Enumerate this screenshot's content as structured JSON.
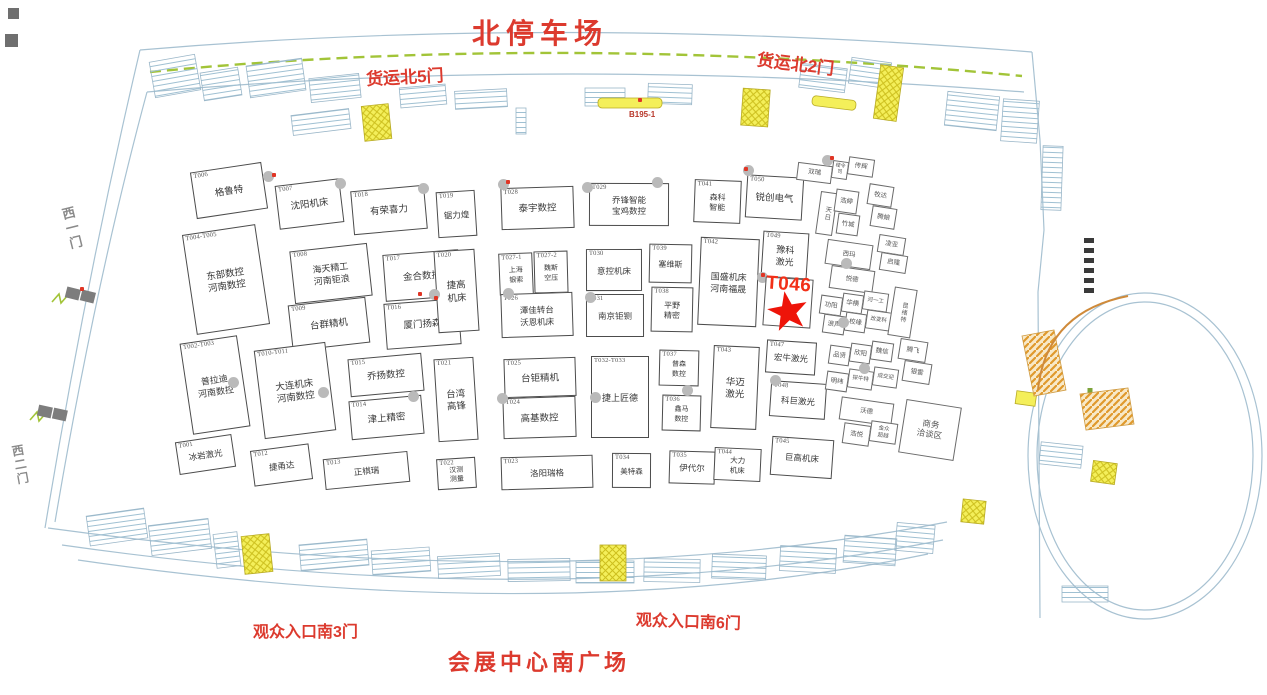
{
  "labels": {
    "north_parking": "北停车场",
    "freight_gate_5": "货运北5门",
    "freight_gate_2": "货运北2门",
    "west_gate_1": "西一门",
    "west_gate_2": "西二门",
    "south_entrance_3": "观众入口南3门",
    "south_entrance_6": "观众入口南6门",
    "south_plaza": "会展中心南广场",
    "zone_code": "B195-1",
    "highlight_code": "T046"
  },
  "colors": {
    "label_red": "#DC3A2E",
    "star_red": "#EE1409",
    "booth_border": "#4C4C4C",
    "green_edge": "#A2C438",
    "stair_yellow": "#F4EF5A",
    "escalator_orange": "#E0992C",
    "wall_blue": "#A8C2D2",
    "pillar_gray": "#BABABA"
  },
  "booths": [
    {
      "code": "T006",
      "name": "格鲁特",
      "x": 193,
      "y": 167,
      "w": 72,
      "h": 47
    },
    {
      "code": "T007",
      "name": "沈阳机床",
      "x": 277,
      "y": 182,
      "w": 65,
      "h": 44
    },
    {
      "code": "T018",
      "name": "有荣喜力",
      "x": 352,
      "y": 188,
      "w": 74,
      "h": 44
    },
    {
      "code": "T019",
      "name": "锯力煌",
      "x": 437,
      "y": 191,
      "w": 39,
      "h": 46,
      "fs": 8.5
    },
    {
      "code": "T028",
      "name": "泰宇数控",
      "x": 501,
      "y": 187,
      "w": 73,
      "h": 42
    },
    {
      "code": "T029",
      "name": "乔锋智能\n宝鸡数控",
      "x": 589,
      "y": 183,
      "w": 80,
      "h": 43,
      "fs": 8.5
    },
    {
      "code": "T041",
      "name": "森科\n智能",
      "x": 694,
      "y": 180,
      "w": 47,
      "h": 43,
      "fs": 8
    },
    {
      "code": "T050",
      "name": "锐创电气",
      "x": 746,
      "y": 176,
      "w": 57,
      "h": 43
    },
    {
      "code": "T004-T005",
      "name": "东部数控\n河南数控",
      "x": 189,
      "y": 229,
      "w": 74,
      "h": 101
    },
    {
      "code": "T008",
      "name": "海天精工\n河南钜浪",
      "x": 292,
      "y": 247,
      "w": 78,
      "h": 53,
      "fs": 9
    },
    {
      "code": "T009",
      "name": "台群精机",
      "x": 290,
      "y": 301,
      "w": 78,
      "h": 46
    },
    {
      "code": "T017",
      "name": "金合数控",
      "x": 384,
      "y": 252,
      "w": 76,
      "h": 47
    },
    {
      "code": "T016",
      "name": "厦门扬森",
      "x": 385,
      "y": 301,
      "w": 75,
      "h": 46
    },
    {
      "code": "T020",
      "name": "捷高\n机床",
      "x": 436,
      "y": 250,
      "w": 41,
      "h": 82
    },
    {
      "code": "T027-1",
      "name": "上海\n银索",
      "x": 499,
      "y": 253,
      "w": 34,
      "h": 42,
      "fs": 7
    },
    {
      "code": "T027-2",
      "name": "魏斯\n空压",
      "x": 534,
      "y": 251,
      "w": 34,
      "h": 42,
      "fs": 7
    },
    {
      "code": "T026",
      "name": "潭佳转台\n沃恩机床",
      "x": 501,
      "y": 293,
      "w": 72,
      "h": 44,
      "fs": 8.5
    },
    {
      "code": "T030",
      "name": "意控机床",
      "x": 586,
      "y": 249,
      "w": 56,
      "h": 42,
      "fs": 8.5
    },
    {
      "code": "T031",
      "name": "南京钜铡",
      "x": 586,
      "y": 294,
      "w": 58,
      "h": 43,
      "fs": 8.5
    },
    {
      "code": "T039",
      "name": "塞维斯",
      "x": 649,
      "y": 244,
      "w": 43,
      "h": 39,
      "fs": 8
    },
    {
      "code": "T038",
      "name": "平野\n精密",
      "x": 651,
      "y": 287,
      "w": 42,
      "h": 45,
      "fs": 8
    },
    {
      "code": "T042",
      "name": "国盛机床\n河南福晟",
      "x": 699,
      "y": 238,
      "w": 59,
      "h": 88,
      "fs": 9
    },
    {
      "code": "T049",
      "name": "豫科\n激光",
      "x": 762,
      "y": 232,
      "w": 46,
      "h": 46,
      "fs": 9
    },
    {
      "code": "T002-T003",
      "name": "普拉迪\n河南数控",
      "x": 186,
      "y": 339,
      "w": 58,
      "h": 92,
      "fs": 9
    },
    {
      "code": "T010-T011",
      "name": "大连机床\n河南数控",
      "x": 259,
      "y": 346,
      "w": 72,
      "h": 89
    },
    {
      "code": "T015",
      "name": "乔扬数控",
      "x": 349,
      "y": 356,
      "w": 74,
      "h": 38
    },
    {
      "code": "T014",
      "name": "津上精密",
      "x": 350,
      "y": 398,
      "w": 73,
      "h": 39
    },
    {
      "code": "T021",
      "name": "台湾\n高锋",
      "x": 436,
      "y": 358,
      "w": 40,
      "h": 83
    },
    {
      "code": "T025",
      "name": "台钜精机",
      "x": 504,
      "y": 358,
      "w": 72,
      "h": 39
    },
    {
      "code": "T024",
      "name": "高基数控",
      "x": 503,
      "y": 397,
      "w": 73,
      "h": 41
    },
    {
      "code": "T032-T033",
      "name": "捷上匠德",
      "x": 591,
      "y": 356,
      "w": 58,
      "h": 82,
      "fs": 9
    },
    {
      "code": "T037",
      "name": "普森\n数控",
      "x": 659,
      "y": 350,
      "w": 40,
      "h": 36,
      "fs": 7
    },
    {
      "code": "T036",
      "name": "鑫马\n数控",
      "x": 662,
      "y": 395,
      "w": 39,
      "h": 36,
      "fs": 7
    },
    {
      "code": "T043",
      "name": "华迈\n激光",
      "x": 712,
      "y": 346,
      "w": 46,
      "h": 83
    },
    {
      "code": "T047",
      "name": "宏牛激光",
      "x": 766,
      "y": 341,
      "w": 50,
      "h": 33,
      "fs": 8.5
    },
    {
      "code": "T048",
      "name": "科巨激光",
      "x": 770,
      "y": 382,
      "w": 56,
      "h": 36,
      "fs": 8.5
    },
    {
      "code": "T001",
      "name": "冰岩激光",
      "x": 177,
      "y": 438,
      "w": 57,
      "h": 33,
      "fs": 8.5
    },
    {
      "code": "T012",
      "name": "捷甬达",
      "x": 252,
      "y": 447,
      "w": 59,
      "h": 36,
      "fs": 8.5
    },
    {
      "code": "T013",
      "name": "正棋瑞",
      "x": 324,
      "y": 455,
      "w": 85,
      "h": 31,
      "fs": 8.5
    },
    {
      "code": "T022",
      "name": "汉测\n测量",
      "x": 437,
      "y": 458,
      "w": 39,
      "h": 31,
      "fs": 7
    },
    {
      "code": "T023",
      "name": "洛阳瑞格",
      "x": 501,
      "y": 456,
      "w": 92,
      "h": 33,
      "fs": 8.5
    },
    {
      "code": "T034",
      "name": "美特森",
      "x": 612,
      "y": 453,
      "w": 39,
      "h": 35,
      "fs": 7.5
    },
    {
      "code": "T035",
      "name": "伊代尔",
      "x": 669,
      "y": 451,
      "w": 46,
      "h": 33,
      "fs": 8.5
    },
    {
      "code": "T044",
      "name": "大力\n机床",
      "x": 714,
      "y": 448,
      "w": 47,
      "h": 33,
      "fs": 7.5
    },
    {
      "code": "T045",
      "name": "巨高机床",
      "x": 771,
      "y": 438,
      "w": 62,
      "h": 39,
      "fs": 8.5
    }
  ],
  "mini_booths": [
    {
      "name": "双瑞",
      "x": 797,
      "y": 164,
      "w": 35,
      "h": 18,
      "r": 7
    },
    {
      "name": "楼令司",
      "x": 832,
      "y": 161,
      "w": 16,
      "h": 18,
      "r": 8,
      "fs": 5
    },
    {
      "name": "传辉",
      "x": 848,
      "y": 158,
      "w": 26,
      "h": 18,
      "r": 8
    },
    {
      "name": "天日",
      "x": 818,
      "y": 192,
      "w": 17,
      "h": 43,
      "r": 8,
      "vert": true
    },
    {
      "name": "浩婷",
      "x": 835,
      "y": 190,
      "w": 23,
      "h": 23,
      "r": 8
    },
    {
      "name": "竹城",
      "x": 837,
      "y": 214,
      "w": 22,
      "h": 21,
      "r": 8
    },
    {
      "name": "牧达",
      "x": 868,
      "y": 185,
      "w": 25,
      "h": 21,
      "r": 9
    },
    {
      "name": "腾娘",
      "x": 871,
      "y": 207,
      "w": 25,
      "h": 21,
      "r": 9
    },
    {
      "name": "西玛",
      "x": 826,
      "y": 242,
      "w": 46,
      "h": 25,
      "r": 8
    },
    {
      "name": "悦德",
      "x": 830,
      "y": 268,
      "w": 44,
      "h": 23,
      "r": 8
    },
    {
      "name": "凌亚",
      "x": 878,
      "y": 236,
      "w": 27,
      "h": 18,
      "r": 9
    },
    {
      "name": "启隆",
      "x": 880,
      "y": 254,
      "w": 27,
      "h": 18,
      "r": 9
    },
    {
      "name": "功阳",
      "x": 820,
      "y": 296,
      "w": 22,
      "h": 19,
      "r": 8
    },
    {
      "name": "华横",
      "x": 842,
      "y": 294,
      "w": 21,
      "h": 19,
      "r": 8
    },
    {
      "name": "河一工",
      "x": 863,
      "y": 292,
      "w": 25,
      "h": 19,
      "r": 8,
      "fs": 5.5
    },
    {
      "name": "浪声",
      "x": 823,
      "y": 315,
      "w": 22,
      "h": 19,
      "r": 8
    },
    {
      "name": "校缘",
      "x": 845,
      "y": 313,
      "w": 21,
      "h": 19,
      "r": 8
    },
    {
      "name": "改变科",
      "x": 866,
      "y": 311,
      "w": 25,
      "h": 19,
      "r": 8,
      "fs": 5.5
    },
    {
      "name": "昆绪特",
      "x": 891,
      "y": 288,
      "w": 23,
      "h": 49,
      "r": 9,
      "vert": true,
      "fs": 6
    },
    {
      "name": "品贤",
      "x": 829,
      "y": 346,
      "w": 21,
      "h": 19,
      "r": 8
    },
    {
      "name": "欣阳",
      "x": 850,
      "y": 344,
      "w": 21,
      "h": 19,
      "r": 8
    },
    {
      "name": "魏信",
      "x": 871,
      "y": 342,
      "w": 22,
      "h": 19,
      "r": 8
    },
    {
      "name": "明纬",
      "x": 826,
      "y": 372,
      "w": 22,
      "h": 19,
      "r": 8
    },
    {
      "name": "探牛特",
      "x": 848,
      "y": 370,
      "w": 25,
      "h": 19,
      "r": 8,
      "fs": 5.5
    },
    {
      "name": "成交迎",
      "x": 873,
      "y": 368,
      "w": 25,
      "h": 19,
      "r": 8,
      "fs": 5.5
    },
    {
      "name": "腾飞",
      "x": 899,
      "y": 340,
      "w": 28,
      "h": 21,
      "r": 9
    },
    {
      "name": "银雷",
      "x": 903,
      "y": 362,
      "w": 28,
      "h": 21,
      "r": 9
    },
    {
      "name": "沃德",
      "x": 840,
      "y": 400,
      "w": 53,
      "h": 23,
      "r": 8
    },
    {
      "name": "浩悦",
      "x": 843,
      "y": 424,
      "w": 27,
      "h": 21,
      "r": 8
    },
    {
      "name": "金众\n超越",
      "x": 870,
      "y": 422,
      "w": 27,
      "h": 21,
      "r": 8,
      "fs": 5.5
    },
    {
      "name": "商务\n洽谈区",
      "x": 902,
      "y": 403,
      "w": 56,
      "h": 54,
      "r": 9,
      "fs": 8.5
    }
  ],
  "pillars": [
    [
      268,
      176
    ],
    [
      340,
      183
    ],
    [
      423,
      188
    ],
    [
      503,
      184
    ],
    [
      587,
      187
    ],
    [
      657,
      182
    ],
    [
      748,
      170
    ],
    [
      827,
      160
    ],
    [
      434,
      294
    ],
    [
      508,
      293
    ],
    [
      590,
      297
    ],
    [
      762,
      277
    ],
    [
      846,
      263
    ],
    [
      843,
      322
    ],
    [
      233,
      382
    ],
    [
      323,
      392
    ],
    [
      413,
      396
    ],
    [
      502,
      398
    ],
    [
      595,
      397
    ],
    [
      687,
      390
    ],
    [
      775,
      380
    ],
    [
      864,
      368
    ]
  ],
  "red_marks": [
    [
      272,
      173
    ],
    [
      506,
      180
    ],
    [
      744,
      167
    ],
    [
      830,
      156
    ],
    [
      761,
      273
    ],
    [
      434,
      296
    ],
    [
      80,
      287
    ],
    [
      638,
      98
    ],
    [
      418,
      292
    ]
  ]
}
